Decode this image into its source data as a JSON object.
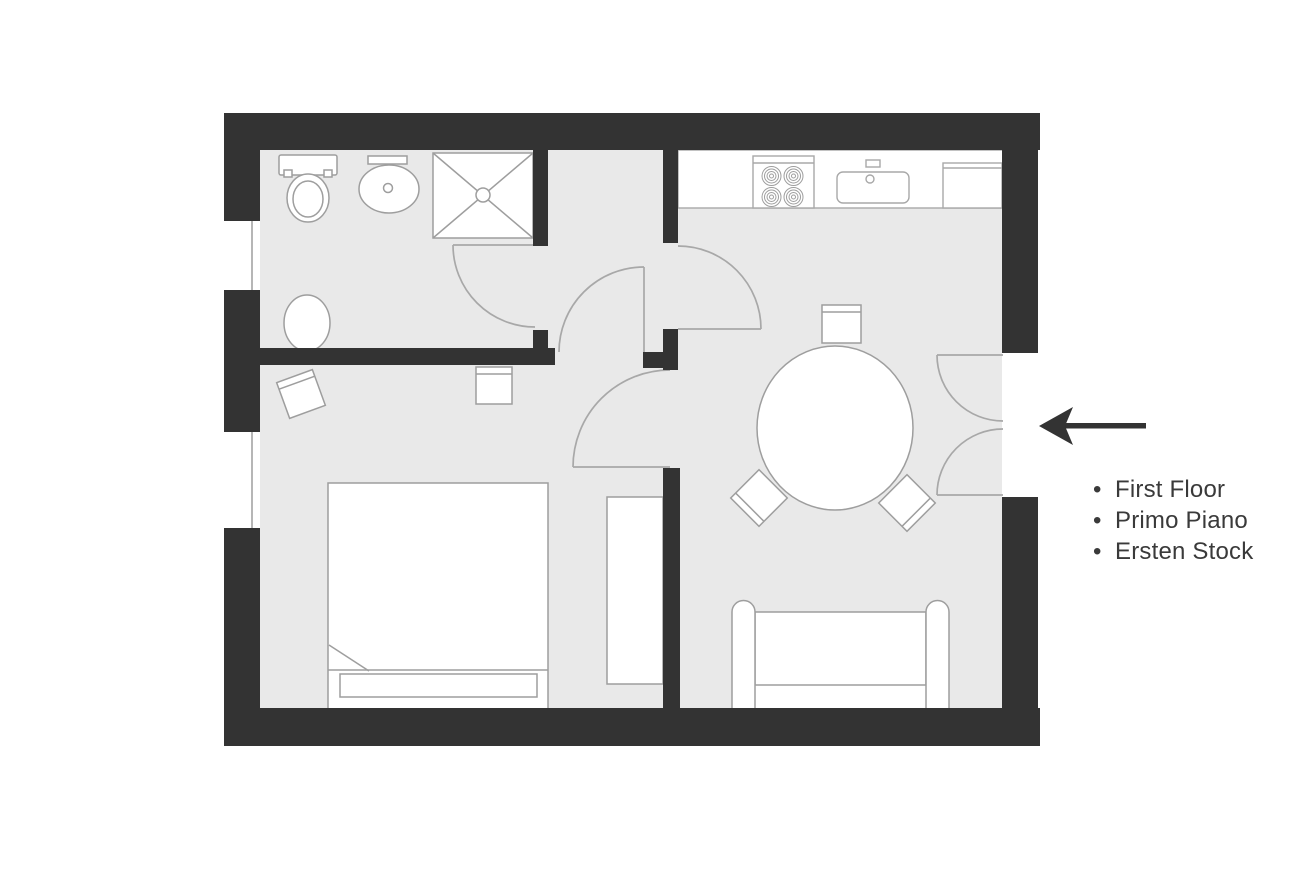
{
  "legend": {
    "bullet": "•",
    "items": [
      {
        "label": "First Floor"
      },
      {
        "label": "Primo Piano"
      },
      {
        "label": "Ersten Stock"
      }
    ]
  },
  "plan": {
    "type": "apartment-floor-plan",
    "entrance_arrow_direction": "left",
    "rooms_implied": [
      "bathroom",
      "hallway",
      "bedroom",
      "kitchen-living-room"
    ],
    "fixtures": [
      "toilet",
      "bathroom-sink",
      "shower",
      "bidet",
      "kitchen-counter",
      "stove-4-burners",
      "kitchen-sink",
      "fridge",
      "round-dining-table",
      "dining-chair",
      "dining-chair",
      "dining-chair",
      "double-bed",
      "wardrobe",
      "bedroom-chair",
      "bedroom-stool",
      "sofa",
      "entrance-double-door",
      "window",
      "window"
    ]
  },
  "colors": {
    "background": "#ffffff",
    "wall": "#333333",
    "floor": "#e9e9e9",
    "furniture_fill": "#ffffff",
    "furniture_outline": "#9e9e9e",
    "door_arc": "#a8a8a8",
    "arrow": "#333333",
    "text": "#3a3a3a"
  }
}
